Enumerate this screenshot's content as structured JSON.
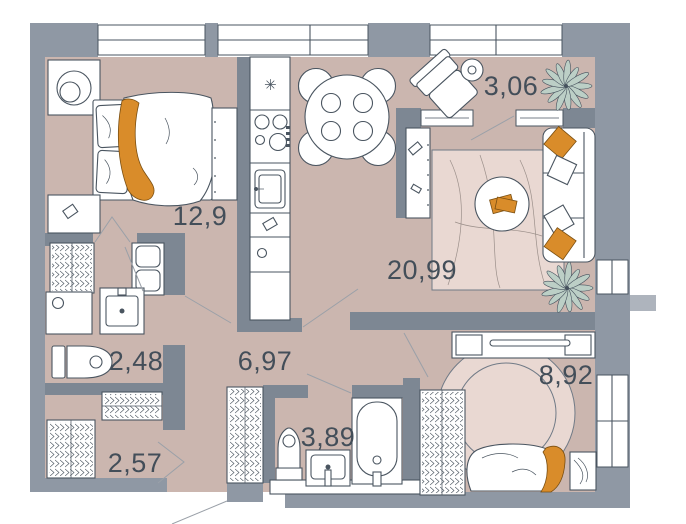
{
  "plan": {
    "type": "apartment-floor-plan",
    "rooms": [
      {
        "id": "bedroom-1",
        "area_label": "12,9",
        "furniture": [
          "double-bed",
          "pillows",
          "orange-throw",
          "nightstand-with-lamp",
          "nightstand",
          "tall-wardrobe",
          "door"
        ]
      },
      {
        "id": "loggia",
        "area_label": "3,06",
        "furniture": [
          "lounge-chair",
          "side-table",
          "plant",
          "window-sill",
          "balcony-door"
        ]
      },
      {
        "id": "kitchen-living",
        "area_label": "20,99",
        "furniture": [
          "fridge",
          "stove",
          "kitchen-sink",
          "kitchen-counter",
          "dining-table-4-seats",
          "console-cabinet",
          "rug",
          "coffee-table",
          "books",
          "sofa",
          "cushions",
          "plant"
        ]
      },
      {
        "id": "bathroom-small",
        "area_label": "2,48",
        "furniture": [
          "coat-closet",
          "washer-dryer-stack",
          "washing-machine",
          "sink",
          "toilet"
        ]
      },
      {
        "id": "hallway",
        "area_label": "6,97",
        "furniture": [
          "wardrobe",
          "entrance-door"
        ]
      },
      {
        "id": "closet",
        "area_label": "2,57",
        "furniture": [
          "wardrobe-top",
          "wardrobe-left"
        ]
      },
      {
        "id": "bathroom-large",
        "area_label": "3,89",
        "furniture": [
          "toilet",
          "sink",
          "bathtub"
        ]
      },
      {
        "id": "bedroom-2",
        "area_label": "8,92",
        "furniture": [
          "wardrobe",
          "desk-with-stools",
          "round-rug",
          "single-bed",
          "orange-blanket",
          "nightstand",
          "window"
        ]
      }
    ],
    "icons": {
      "fridge_snowflake": "✳"
    },
    "colors": {
      "floor": "#cbb6af",
      "wall_outer": "#8f98a4",
      "wall_inner": "#7d8793",
      "furniture_outline": "#4a5560",
      "accent_orange": "#d98c2a",
      "plant_green": "#bccfc6",
      "rug_pink": "#e9d8d2",
      "label_text": "#434e59",
      "window_white": "#ffffff"
    }
  }
}
